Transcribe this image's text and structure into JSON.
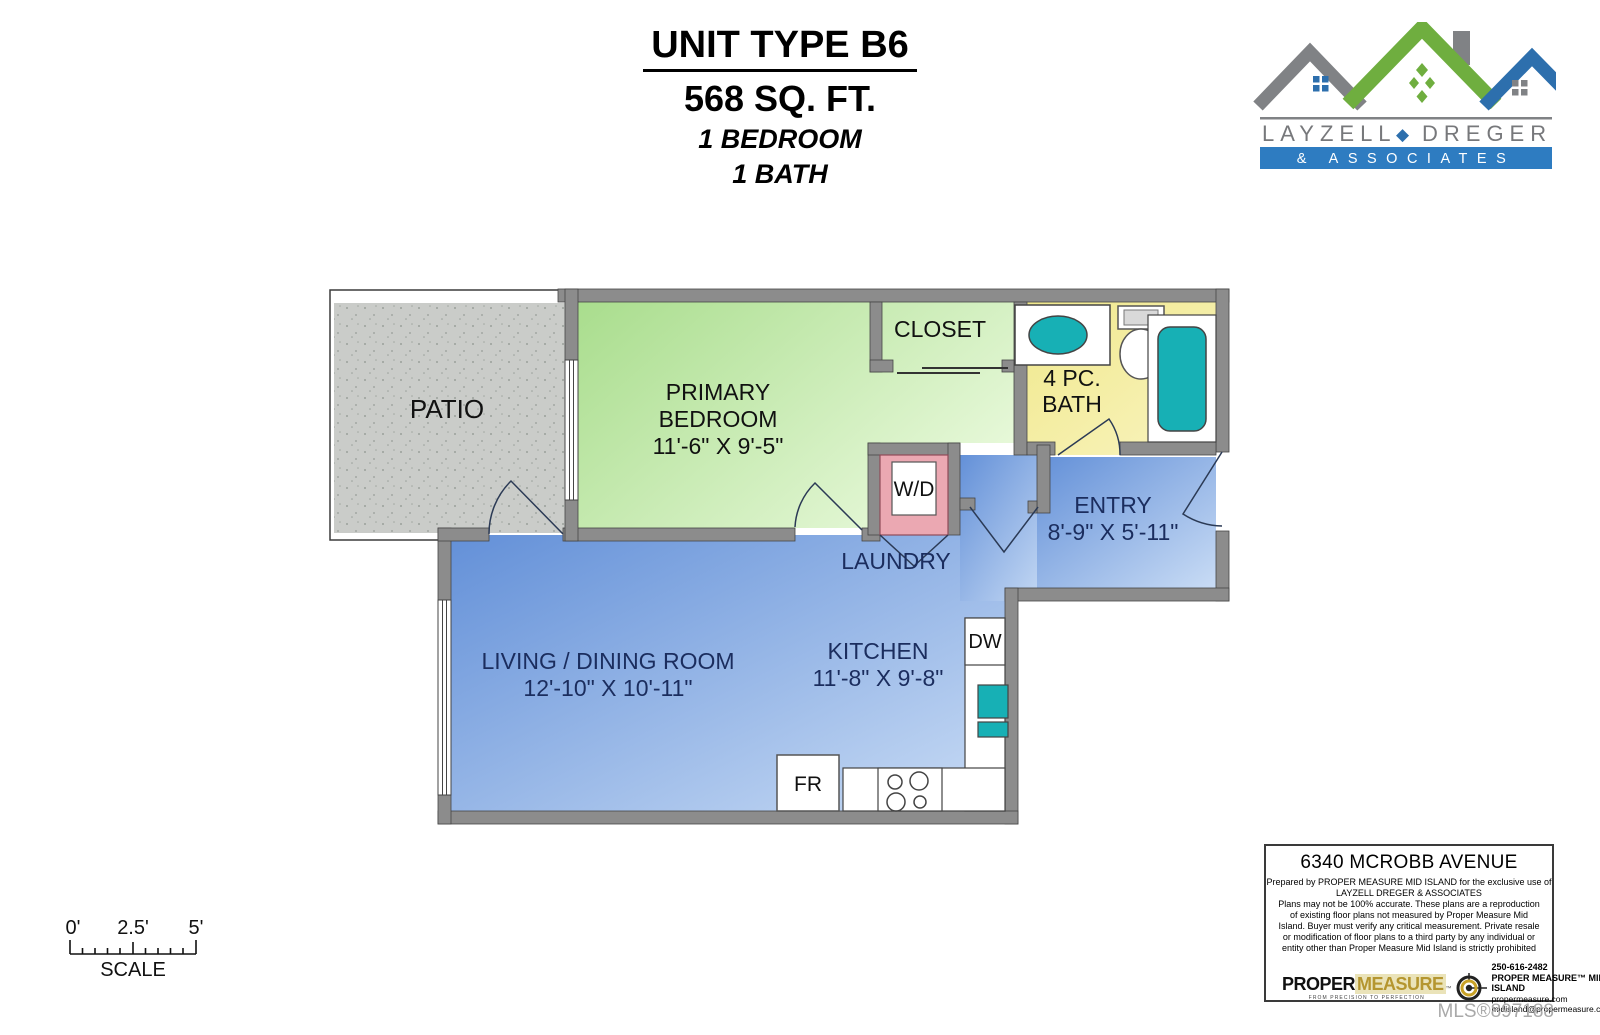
{
  "header": {
    "unit": "UNIT TYPE B6",
    "area": "568 SQ. FT.",
    "bedrooms": "1 BEDROOM",
    "baths": "1 BATH"
  },
  "brand": {
    "name_left": "LAYZELL",
    "name_right": "DREGER",
    "separator_icon": "diamond-icon",
    "separator": "◆",
    "banner": "& ASSOCIATES"
  },
  "plan": {
    "patio": "PATIO",
    "bedroom_line1": "PRIMARY",
    "bedroom_line2": "BEDROOM",
    "bedroom_dims": "11'-6\" X 9'-5\"",
    "closet": "CLOSET",
    "bath_line1": "4 PC.",
    "bath_line2": "BATH",
    "wd": "W/D",
    "laundry": "LAUNDRY",
    "entry": "ENTRY",
    "entry_dims": "8'-9\" X 5'-11\"",
    "living": "LIVING / DINING ROOM",
    "living_dims": "12'-10\" X 10'-11\"",
    "kitchen": "KITCHEN",
    "kitchen_dims": "11'-8\" X 9'-8\"",
    "dw": "DW",
    "fr": "FR"
  },
  "scale": {
    "tick0": "0'",
    "tick1": "2.5'",
    "tick2": "5'",
    "label": "SCALE"
  },
  "footer": {
    "address": "6340 MCROBB AVENUE",
    "prepared_line1": "Prepared by PROPER MEASURE MID ISLAND for the exclusive use of",
    "prepared_line2": "LAYZELL DREGER & ASSOCIATES",
    "body": "Plans may not be 100% accurate. These plans are a reproduction of existing floor plans not measured by  Proper Measure Mid Island. Buyer must verify any critical measurement.  Private resale  or modification of floor plans to a third party by any individual or entity other than Proper Measure Mid Island is strictly prohibited",
    "pm_word1": "PROPER",
    "pm_word2": "MEASURE",
    "pm_tm": "™",
    "pm_tagline": "FROM PRECISION TO PERFECTION",
    "phone": "250-616-2482",
    "company": "PROPER MEASURE™ MID ISLAND",
    "website": "propermeasure.com",
    "email": "midisland@propermeasure.com"
  },
  "mls": "MLS®897188",
  "colors": {
    "wall_gray": "#8c8c8c",
    "patio_gray": "#caccc9",
    "bedroom_green": "#b5e29a",
    "bath_yellow": "#f0e88c",
    "room_blue": "#6a95da",
    "wd_pink": "#eba8b2",
    "fixture_teal": "#17b0b5",
    "label_navy": "#1b2d5e",
    "logo_green": "#6fae3f",
    "logo_blue": "#2d6fad",
    "logo_gray": "#808285",
    "banner_blue": "#2e7cc1",
    "pm_gold": "#b5962f"
  }
}
